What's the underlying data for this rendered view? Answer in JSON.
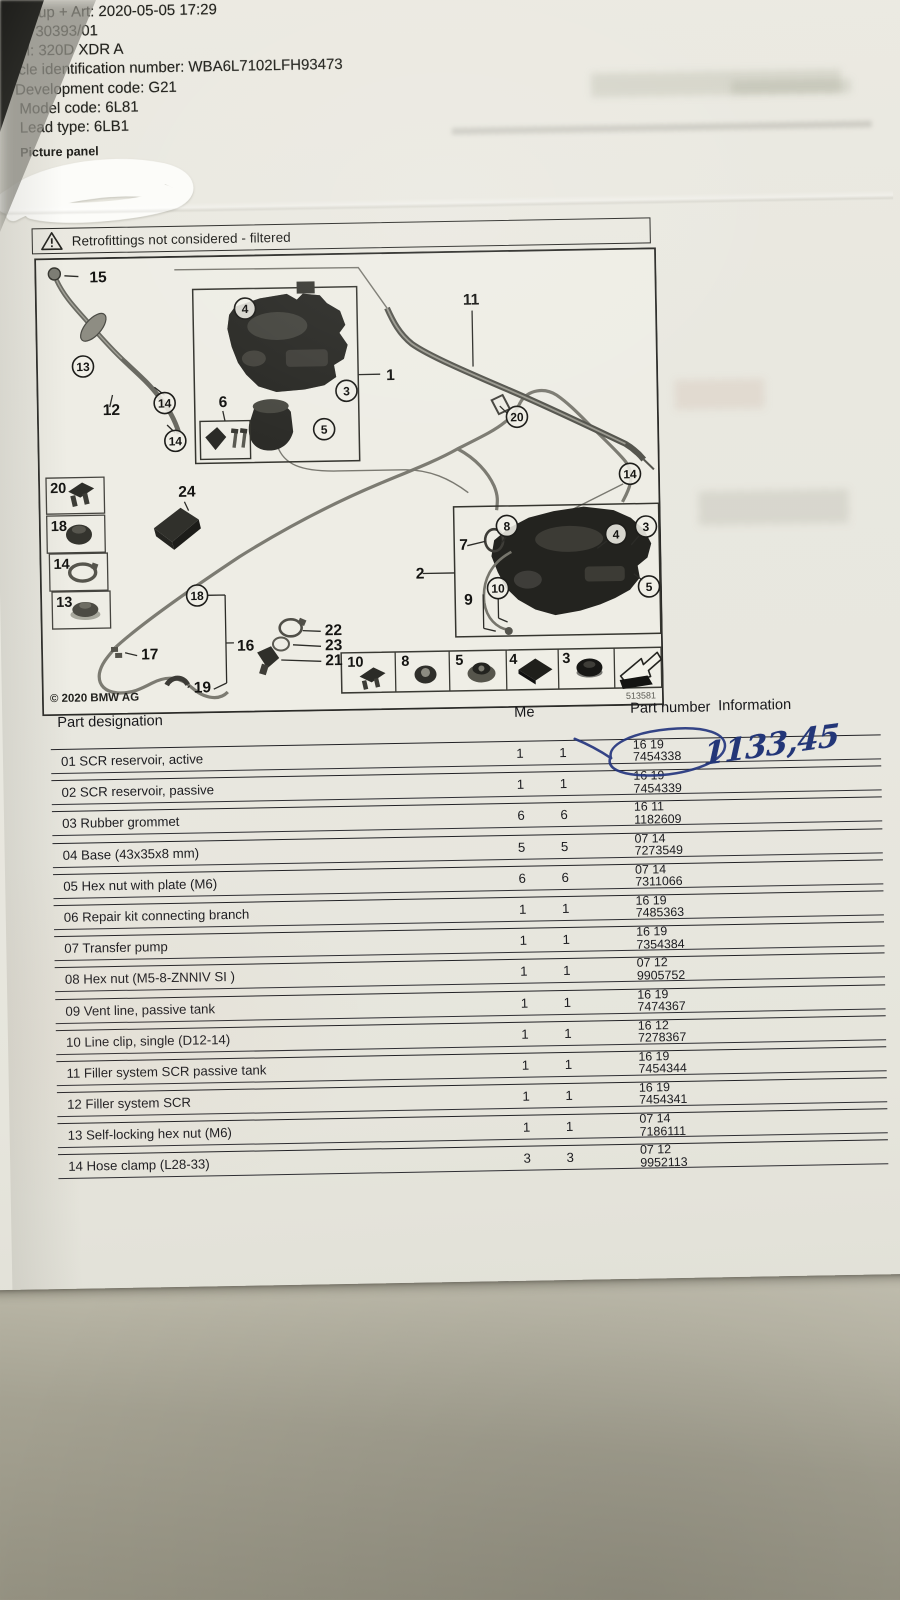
{
  "header": {
    "lines": [
      "oup + Art: 2020-05-05 17:29",
      "r: 30393/01",
      "el: 320D XDR A",
      "hicle identification number: WBA6L7102LFH93473",
      "Development code: G21",
      "Model code: 6L81",
      "Lead type: 6LB1"
    ],
    "picture_panel_label": "Picture panel"
  },
  "warning": {
    "text": "Retrofittings not considered - filtered"
  },
  "diagram": {
    "copyright": "© 2020 BMW AG",
    "figure_number": "513581",
    "circled_callouts": [
      {
        "n": "4",
        "x": 210,
        "y": 54
      },
      {
        "n": "3",
        "x": 310,
        "y": 138
      },
      {
        "n": "5",
        "x": 287,
        "y": 176
      },
      {
        "n": "13",
        "x": 47,
        "y": 109
      },
      {
        "n": "14",
        "x": 128,
        "y": 147
      },
      {
        "n": "14",
        "x": 138,
        "y": 185
      },
      {
        "n": "20",
        "x": 480,
        "y": 167
      },
      {
        "n": "14",
        "x": 592,
        "y": 226
      },
      {
        "n": "18",
        "x": 157,
        "y": 340
      },
      {
        "n": "8",
        "x": 468,
        "y": 276
      },
      {
        "n": "10",
        "x": 458,
        "y": 338
      },
      {
        "n": "4",
        "x": 577,
        "y": 286
      },
      {
        "n": "3",
        "x": 607,
        "y": 279
      },
      {
        "n": "5",
        "x": 609,
        "y": 339
      }
    ],
    "plain_callouts": [
      {
        "n": "15",
        "x": 55,
        "y": 25
      },
      {
        "n": "12",
        "x": 66,
        "y": 158
      },
      {
        "n": "1",
        "x": 350,
        "y": 128
      },
      {
        "n": "11",
        "x": 428,
        "y": 54
      },
      {
        "n": "6",
        "x": 182,
        "y": 152
      },
      {
        "n": "24",
        "x": 140,
        "y": 241
      },
      {
        "n": "16",
        "x": 196,
        "y": 396
      },
      {
        "n": "17",
        "x": 100,
        "y": 403
      },
      {
        "n": "19",
        "x": 152,
        "y": 437
      },
      {
        "n": "22",
        "x": 284,
        "y": 382
      },
      {
        "n": "23",
        "x": 284,
        "y": 397
      },
      {
        "n": "21",
        "x": 284,
        "y": 412
      },
      {
        "n": "2",
        "x": 376,
        "y": 327
      },
      {
        "n": "7",
        "x": 420,
        "y": 299
      },
      {
        "n": "9",
        "x": 424,
        "y": 354
      }
    ],
    "sidebar_boxes": [
      {
        "n": "20",
        "x": 8,
        "y": 220
      },
      {
        "n": "18",
        "x": 8,
        "y": 258
      },
      {
        "n": "14",
        "x": 10,
        "y": 296
      },
      {
        "n": "13",
        "x": 12,
        "y": 334
      }
    ],
    "legend_cells": [
      {
        "n": "10",
        "x": 306
      },
      {
        "n": "8",
        "x": 360
      },
      {
        "n": "5",
        "x": 414
      },
      {
        "n": "4",
        "x": 468
      },
      {
        "n": "3",
        "x": 521
      }
    ]
  },
  "table": {
    "headers": {
      "designation": "Part designation",
      "quantity": "Me",
      "part_number": "Part number",
      "information": "Information"
    },
    "rows": [
      {
        "designation": "01 SCR reservoir, active",
        "qty1": "1",
        "qty2": "1",
        "pn_prefix": "16 19",
        "pn": "7454338"
      },
      {
        "designation": "02 SCR reservoir, passive",
        "qty1": "1",
        "qty2": "1",
        "pn_prefix": "16 19",
        "pn": "7454339"
      },
      {
        "designation": "03 Rubber grommet",
        "qty1": "6",
        "qty2": "6",
        "pn_prefix": "16 11",
        "pn": "1182609"
      },
      {
        "designation": "04 Base (43x35x8 mm)",
        "qty1": "5",
        "qty2": "5",
        "pn_prefix": "07 14",
        "pn": "7273549"
      },
      {
        "designation": "05 Hex nut with plate (M6)",
        "qty1": "6",
        "qty2": "6",
        "pn_prefix": "07 14",
        "pn": "7311066"
      },
      {
        "designation": "06 Repair kit connecting branch",
        "qty1": "1",
        "qty2": "1",
        "pn_prefix": "16 19",
        "pn": "7485363"
      },
      {
        "designation": "07 Transfer pump",
        "qty1": "1",
        "qty2": "1",
        "pn_prefix": "16 19",
        "pn": "7354384"
      },
      {
        "designation": "08 Hex nut (M5-8-ZNNIV SI )",
        "qty1": "1",
        "qty2": "1",
        "pn_prefix": "07 12",
        "pn": "9905752"
      },
      {
        "designation": "09 Vent line, passive tank",
        "qty1": "1",
        "qty2": "1",
        "pn_prefix": "16 19",
        "pn": "7474367"
      },
      {
        "designation": "10 Line clip, single (D12-14)",
        "qty1": "1",
        "qty2": "1",
        "pn_prefix": "16 12",
        "pn": "7278367"
      },
      {
        "designation": "11 Filler system SCR passive tank",
        "qty1": "1",
        "qty2": "1",
        "pn_prefix": "16 19",
        "pn": "7454344"
      },
      {
        "designation": "12 Filler system SCR",
        "qty1": "1",
        "qty2": "1",
        "pn_prefix": "16 19",
        "pn": "7454341"
      },
      {
        "designation": "13 Self-locking hex nut (M6)",
        "qty1": "1",
        "qty2": "1",
        "pn_prefix": "07 14",
        "pn": "7186111"
      },
      {
        "designation": "14 Hose clamp (L28-33)",
        "qty1": "3",
        "qty2": "3",
        "pn_prefix": "07 12",
        "pn": "9952113"
      }
    ]
  },
  "handwriting": {
    "price": "1133,45",
    "ink_color": "#233678"
  }
}
